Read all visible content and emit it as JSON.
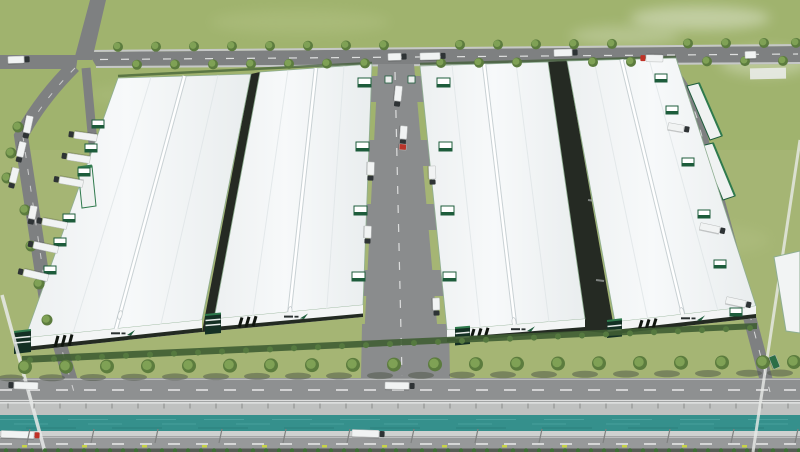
{
  "scene": {
    "title": "Aerial rendering of a logistics industrial park",
    "description": "Bird's-eye 3D render: four large white-roofed warehouses with green-trimmed facades and corner office blocks, a central service road with loading docks and trucks, tree-lined perimeter roads, a crossroads at upper left, and a foreground boulevard split by a teal canal."
  },
  "colors": {
    "grass": "#a5b574",
    "grass_top": "#9cb168",
    "road": "#7e8081",
    "road_mid": "#8a8c8d",
    "road_upper_blvd": "#8e9091",
    "road_lower_blvd": "#97999a",
    "sidewalk": "#c6c8c7",
    "wall": "#bfc1c0",
    "wall_light": "#dcdedd",
    "canal": "#35908c",
    "canal_streak": "#5fb3ae",
    "roof_light": "#f6f8f9",
    "roof_mid": "#eef1f2",
    "roof_edge_green": "#8fae92",
    "ridge_white": "#ffffff",
    "ridge_case": "#c9d1d4",
    "seam": "#dfe5e7",
    "facade_white": "#f3f5f5",
    "facade_dark": "#232a22",
    "stripe_black": "#10150f",
    "accent_green": "#1d5c3b",
    "accent_green_bright": "#2f7a4d",
    "accent_green_dark": "#143024",
    "gap_dark": "#252a23",
    "hedge": "#3f5d33",
    "hedge_bottom": "#3f6d36",
    "tree": "#7fa155",
    "tree_dark": "#5c7c3e",
    "tree_shadow": "#4b5345",
    "bush": "#55793f",
    "truck_white": "#f1f3f3",
    "cab_dark": "#2e3335",
    "cab_red": "#c03227",
    "body_red": "#b8342a",
    "body_green": "#2c6e46",
    "plant_yellow": "#c6d348",
    "marking_white": "#ffffff",
    "haze_white": "#ffffff",
    "logo_text_dark": "#2a3030"
  },
  "counts": {
    "warehouses": 4,
    "front_row_trees": 20,
    "vehicles": 31
  },
  "trees": [
    {
      "name": "top-road-upper-row",
      "r": 5,
      "shadow": false,
      "x0": 100,
      "y0": 47,
      "slope": -0.006,
      "xs": [
        118,
        156,
        194,
        232,
        270,
        308,
        346,
        384,
        460,
        498,
        536,
        574,
        612,
        688,
        726,
        764,
        796
      ]
    },
    {
      "name": "top-road-lower-row",
      "r": 5,
      "shadow": false,
      "x0": 100,
      "y0": 65,
      "slope": -0.006,
      "xs": [
        137,
        175,
        213,
        251,
        289,
        327,
        365,
        441,
        479,
        517,
        593,
        631,
        707,
        745,
        783
      ]
    },
    {
      "name": "front-row",
      "r": 7,
      "shadow": true,
      "x0": 25,
      "y0": 367,
      "slope": -0.0065,
      "xs": [
        25,
        66,
        107,
        148,
        189,
        230,
        271,
        312,
        353,
        394,
        435,
        476,
        517,
        558,
        599,
        640,
        681,
        722,
        763,
        794
      ]
    },
    {
      "name": "left-road-row",
      "r": 5.5,
      "shadow": false,
      "pts": [
        [
          18,
          127
        ],
        [
          11,
          153
        ],
        [
          7,
          178
        ],
        [
          25,
          210
        ],
        [
          31,
          246
        ],
        [
          39,
          284
        ],
        [
          47,
          320
        ]
      ]
    }
  ],
  "bushes": {
    "x0": 30,
    "x_end": 752,
    "step": 24,
    "y0": 360,
    "slope": -0.0444,
    "r": 3
  },
  "vehicles": [
    {
      "x": 8,
      "y": 60,
      "a": -2,
      "l": 16,
      "body": "white",
      "cab": "dark"
    },
    {
      "x": 420,
      "y": 56.5,
      "a": -1.5,
      "l": 20,
      "body": "white",
      "cab": "dark"
    },
    {
      "x": 554,
      "y": 53,
      "a": -1.5,
      "l": 18,
      "body": "white",
      "cab": "dark"
    },
    {
      "x": 663,
      "y": 58.5,
      "a": 181,
      "l": 17,
      "body": "white",
      "cab": "red"
    },
    {
      "x": 745,
      "y": 55,
      "a": -1.5,
      "l": 11,
      "body": "white",
      "cab": "none"
    },
    {
      "x": 388,
      "y": 57,
      "a": -1.5,
      "l": 13,
      "body": "white",
      "cab": "dark"
    },
    {
      "x": 399,
      "y": 86,
      "a": 96,
      "l": 15,
      "body": "white",
      "cab": "dark"
    },
    {
      "x": 404,
      "y": 126,
      "a": 94,
      "l": 13,
      "body": "white",
      "cab": "dark"
    },
    {
      "x": 403,
      "y": 144,
      "a": 94,
      "l": 6,
      "body": "red",
      "cab": "none"
    },
    {
      "x": 371,
      "y": 162,
      "a": 92,
      "l": 13,
      "body": "white",
      "cab": "dark"
    },
    {
      "x": 432,
      "y": 166,
      "a": 88,
      "l": 13,
      "body": "white",
      "cab": "dark"
    },
    {
      "x": 368,
      "y": 226,
      "a": 92,
      "l": 12,
      "body": "white",
      "cab": "dark"
    },
    {
      "x": 436,
      "y": 298,
      "a": 88,
      "l": 12,
      "body": "white",
      "cab": "dark"
    },
    {
      "x": 30,
      "y": 116,
      "a": 102,
      "l": 17,
      "body": "white",
      "cab": "dark"
    },
    {
      "x": 23,
      "y": 142,
      "a": 103,
      "l": 15,
      "body": "white",
      "cab": "dark"
    },
    {
      "x": 16,
      "y": 168,
      "a": 104,
      "l": 15,
      "body": "white",
      "cab": "dark"
    },
    {
      "x": 34,
      "y": 206,
      "a": 101,
      "l": 13,
      "body": "white",
      "cab": "dark"
    },
    {
      "x": 97,
      "y": 138,
      "a": 188,
      "l": 23,
      "body": "white",
      "cab": "dark"
    },
    {
      "x": 90,
      "y": 160,
      "a": 189,
      "l": 23,
      "body": "white",
      "cab": "dark"
    },
    {
      "x": 83,
      "y": 184,
      "a": 190,
      "l": 24,
      "body": "white",
      "cab": "dark"
    },
    {
      "x": 67,
      "y": 226,
      "a": 191,
      "l": 25,
      "body": "white",
      "cab": "dark"
    },
    {
      "x": 58,
      "y": 250,
      "a": 192,
      "l": 25,
      "body": "white",
      "cab": "dark"
    },
    {
      "x": 48,
      "y": 278,
      "a": 193,
      "l": 25,
      "body": "white",
      "cab": "dark"
    },
    {
      "x": 700,
      "y": 226,
      "a": 12,
      "l": 20,
      "body": "white",
      "cab": "dark"
    },
    {
      "x": 726,
      "y": 300,
      "a": 12,
      "l": 20,
      "body": "white",
      "cab": "dark"
    },
    {
      "x": 668,
      "y": 126,
      "a": 10,
      "l": 16,
      "body": "white",
      "cab": "dark"
    },
    {
      "x": 772,
      "y": 356,
      "a": 68,
      "l": 13,
      "body": "green",
      "cab": "none"
    },
    {
      "x": 38,
      "y": 386,
      "a": 182,
      "l": 24,
      "body": "white",
      "cab": "dark"
    },
    {
      "x": 385,
      "y": 385.5,
      "a": 1,
      "l": 24,
      "body": "white",
      "cab": "dark"
    },
    {
      "x": 1,
      "y": 434,
      "a": 2,
      "l": 33,
      "body": "white",
      "cab": "red"
    },
    {
      "x": 352,
      "y": 433,
      "a": 2,
      "l": 27,
      "body": "white",
      "cab": "dark"
    }
  ],
  "docks": [
    {
      "edge": "central-road-left",
      "w": 13,
      "h": 9,
      "side": "left",
      "pts": [
        [
          371,
          78
        ],
        [
          369,
          142
        ],
        [
          367,
          206
        ],
        [
          365,
          272
        ]
      ]
    },
    {
      "edge": "central-road-right",
      "w": 13,
      "h": 9,
      "side": "right",
      "pts": [
        [
          437,
          78
        ],
        [
          439,
          142
        ],
        [
          441,
          206
        ],
        [
          443,
          272
        ]
      ]
    },
    {
      "edge": "warehouse-4-right",
      "w": 12,
      "h": 8,
      "side": "right",
      "pts": [
        [
          655,
          74
        ],
        [
          666,
          106
        ],
        [
          682,
          158
        ],
        [
          698,
          210
        ],
        [
          714,
          260
        ],
        [
          730,
          308
        ]
      ]
    },
    {
      "edge": "warehouse-1-left",
      "w": 12,
      "h": 8,
      "side": "left",
      "pts": [
        [
          104,
          120
        ],
        [
          97,
          144
        ],
        [
          90,
          168
        ],
        [
          75,
          214
        ],
        [
          66,
          238
        ],
        [
          56,
          266
        ]
      ]
    }
  ],
  "markers": [
    {
      "name": "guardrail-posts",
      "type": "post",
      "x0": 8,
      "step": 26,
      "n": 31,
      "y1": 403.5,
      "y2": 408.5,
      "color": "#898b8a",
      "w": 1
    },
    {
      "name": "median-light-poles",
      "type": "pole",
      "x0": 30,
      "step": 64,
      "n": 13,
      "y1": 429,
      "y2": 443,
      "lean": -3,
      "color": "#7f8180",
      "w": 1.2
    },
    {
      "name": "median-yellow-plants",
      "type": "plant",
      "x0": 22,
      "step": 60,
      "n": 14,
      "y": 445,
      "w": 5,
      "h": 2.5
    },
    {
      "name": "bottom-hedge-row",
      "type": "hedge",
      "x0": 6,
      "step": 13,
      "n": 62,
      "y": 450.5,
      "r": 2.2
    }
  ]
}
